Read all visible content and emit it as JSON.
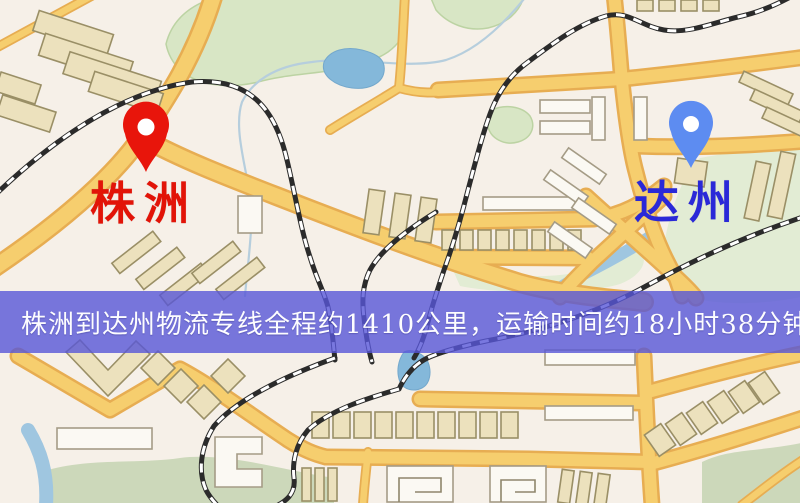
{
  "map": {
    "type": "route-map-illustration",
    "origin": {
      "label": "株洲",
      "label_color": "#e21408",
      "pin": {
        "name": "red-map-pin",
        "color": "#e8150b"
      }
    },
    "destination": {
      "label": "达州",
      "label_color": "#2a28d8",
      "pin": {
        "name": "blue-map-pin",
        "color": "#5d8cf1"
      }
    },
    "banner": {
      "text": "株洲到达州物流专线全程约1410公里，运输时间约18小时38分钟.",
      "distance_km": "1410",
      "duration": "18小时38分钟",
      "bg_color": "#5856d7",
      "text_color": "#fdfdff"
    },
    "colors": {
      "map_background": "#f6f0e8",
      "road_fill": "#f6ce6e",
      "road_casing": "#e7ad52",
      "park_green": "#d8e6c5",
      "water_blue": "#84b8da",
      "building_tan": "#ece1bd",
      "building_white": "#fbf9f3",
      "railway_black": "#2b2b2b"
    }
  }
}
